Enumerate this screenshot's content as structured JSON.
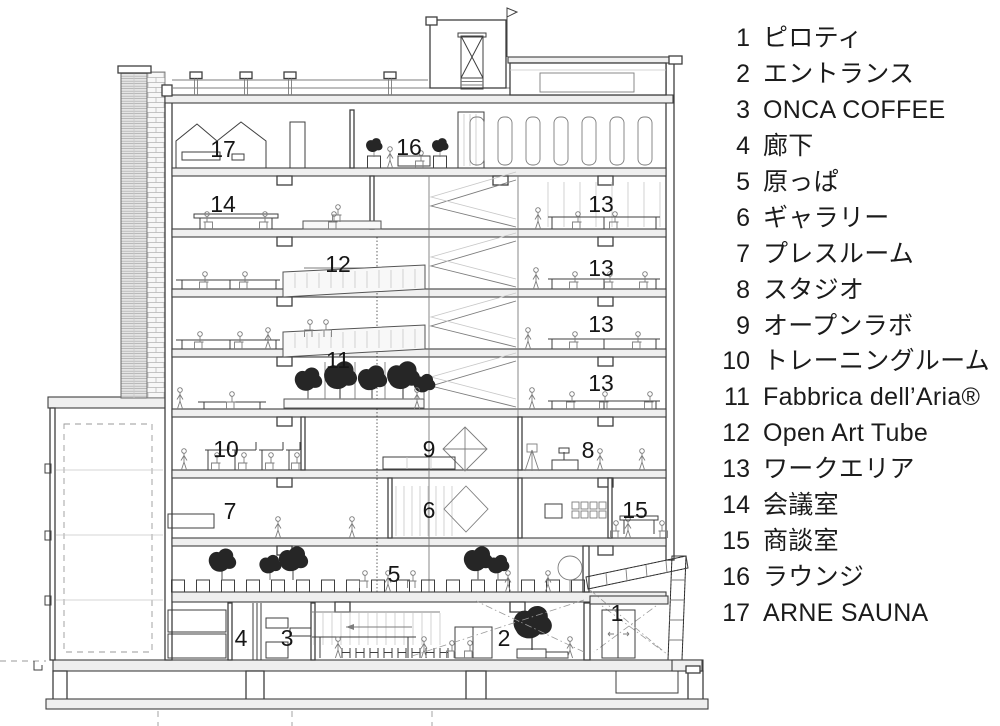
{
  "colors": {
    "background": "#ffffff",
    "ink": "#1b1b1b",
    "line": "#3f3f3f"
  },
  "legend": {
    "items": [
      {
        "number": "1",
        "label": "ピロティ"
      },
      {
        "number": "2",
        "label": "エントランス"
      },
      {
        "number": "3",
        "label": "ONCA COFFEE"
      },
      {
        "number": "4",
        "label": "廊下"
      },
      {
        "number": "5",
        "label": "原っぱ"
      },
      {
        "number": "6",
        "label": "ギャラリー"
      },
      {
        "number": "7",
        "label": "プレスルーム"
      },
      {
        "number": "8",
        "label": "スタジオ"
      },
      {
        "number": "9",
        "label": "オープンラボ"
      },
      {
        "number": "10",
        "label": "トレーニングルーム"
      },
      {
        "number": "11",
        "label": "Fabbrica dell’Aria®"
      },
      {
        "number": "12",
        "label": "Open Art Tube"
      },
      {
        "number": "13",
        "label": "ワークエリア"
      },
      {
        "number": "14",
        "label": "会議室"
      },
      {
        "number": "15",
        "label": "商談室"
      },
      {
        "number": "16",
        "label": "ラウンジ"
      },
      {
        "number": "17",
        "label": "ARNE SAUNA"
      }
    ]
  },
  "drawing": {
    "labels": [
      {
        "id": "sauna",
        "text": "17"
      },
      {
        "id": "lounge",
        "text": "16"
      },
      {
        "id": "meeting-room",
        "text": "14"
      },
      {
        "id": "work-area-8f",
        "text": "13"
      },
      {
        "id": "open-art-tube",
        "text": "12"
      },
      {
        "id": "work-area-7f",
        "text": "13"
      },
      {
        "id": "work-area-6f",
        "text": "13"
      },
      {
        "id": "fabbrica",
        "text": "11"
      },
      {
        "id": "work-area-5f",
        "text": "13"
      },
      {
        "id": "training-room",
        "text": "10"
      },
      {
        "id": "open-lab",
        "text": "9"
      },
      {
        "id": "studio",
        "text": "8"
      },
      {
        "id": "press-room",
        "text": "7"
      },
      {
        "id": "gallery",
        "text": "6"
      },
      {
        "id": "sales-room",
        "text": "15"
      },
      {
        "id": "harappa",
        "text": "5"
      },
      {
        "id": "corridor",
        "text": "4"
      },
      {
        "id": "onca-coffee",
        "text": "3"
      },
      {
        "id": "entrance",
        "text": "2"
      },
      {
        "id": "piloti",
        "text": "1"
      }
    ]
  }
}
